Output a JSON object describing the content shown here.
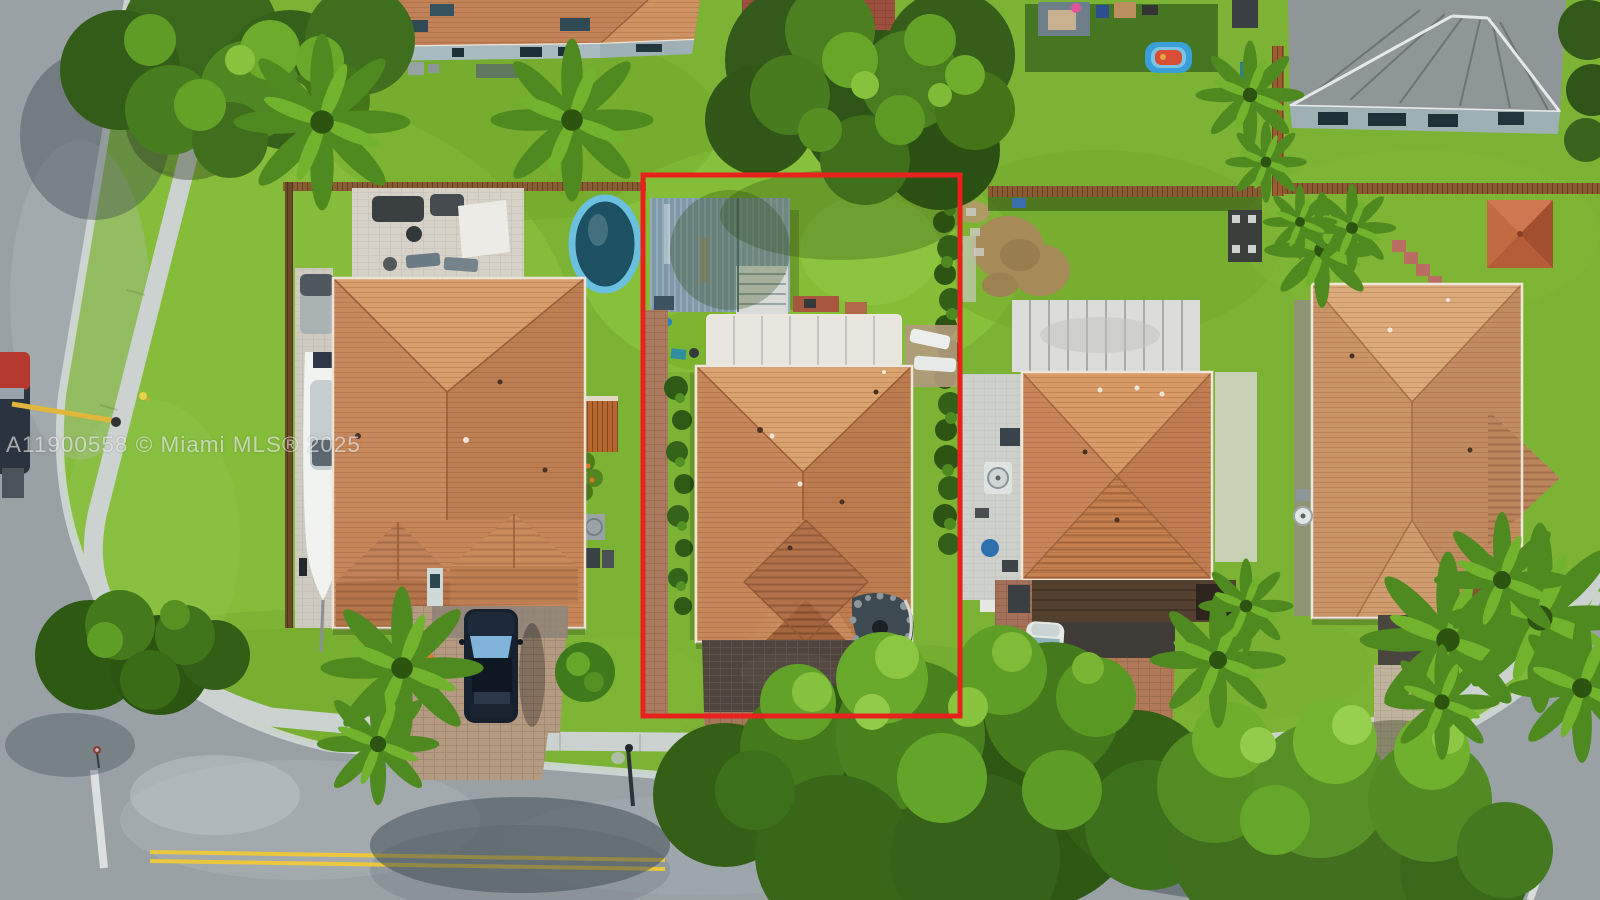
{
  "watermark": {
    "text": "A11900558 © Miami MLS® 2025"
  },
  "colors": {
    "boundary_red": "#e8211d",
    "grass": "#7cb335",
    "road": "#99a1a5",
    "sidewalk": "#ccd2d0",
    "roof_terracotta": "#c98a5c",
    "roof_gray": "#8e9697",
    "metal_shed": "#8ba3b0",
    "canopy_white": "#e8e6df",
    "pool_blue": "#5ab8da",
    "lane_yellow": "#ecc83e"
  },
  "scene": {
    "type": "aerial-photo",
    "annotation": "red rectangle outlining subject property"
  }
}
